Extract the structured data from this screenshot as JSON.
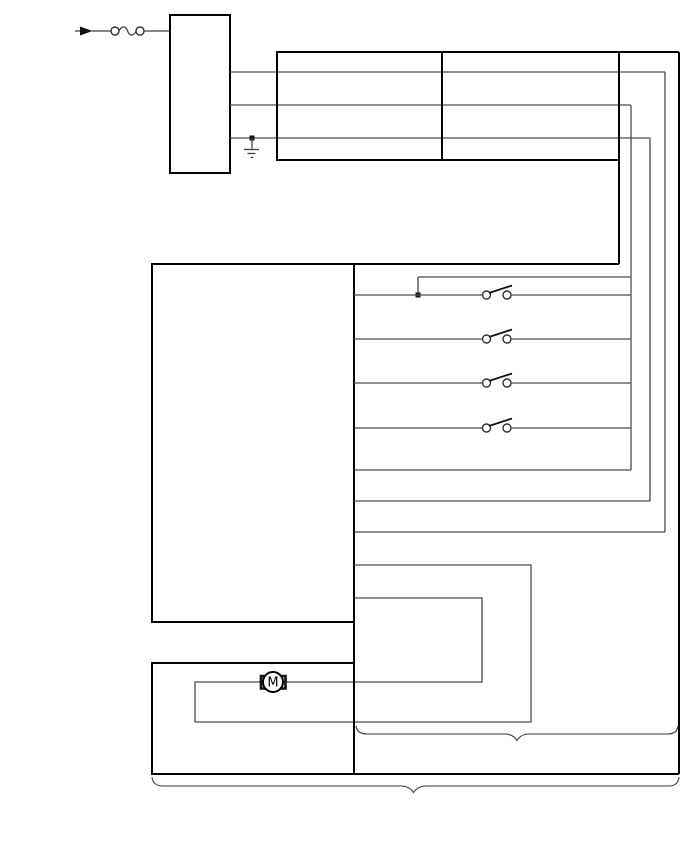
{
  "page": {
    "width": 688,
    "height": 852,
    "background": "#ffffff",
    "view_box": "0 0 688 852"
  },
  "colors": {
    "box_stroke": "#000000",
    "wire_stroke": "#4a4a4a",
    "brace_stroke": "#3a3a3a",
    "background": "#ffffff"
  },
  "motor": {
    "label": "M"
  },
  "legend": {
    "component_names": [
      "power-input-arrow",
      "inline-fuse",
      "power-source-box",
      "fuse-junction-box",
      "ground",
      "control-module-box",
      "switch-1",
      "switch-2",
      "switch-3",
      "switch-4",
      "motor",
      "motor-module-box",
      "section-brace-right",
      "section-brace-bottom"
    ]
  },
  "diagram": {
    "shapes": [
      {
        "type": "line",
        "name": "input-lead-tail",
        "cls": "wire2",
        "x1": 75,
        "y1": 31,
        "x2": 81,
        "y2": 31
      },
      {
        "type": "polygon",
        "name": "power-input-arrow-icon",
        "cls": "solid",
        "points": "80,26.5 92.5,31 80,35.5"
      },
      {
        "type": "line",
        "name": "input-lead",
        "cls": "wire2",
        "x1": 92,
        "y1": 31,
        "x2": 111,
        "y2": 31
      },
      {
        "type": "circle",
        "name": "fuse-contact-left",
        "cls": "contact",
        "cx": 115,
        "cy": 31,
        "r": 4
      },
      {
        "type": "path",
        "name": "fuse-icon",
        "cls": "wire2",
        "d": "M119,31 C122,25.5 125.5,25.5 127.6,31 C129.7,36.5 133.2,36.5 136.2,31"
      },
      {
        "type": "circle",
        "name": "fuse-contact-right",
        "cls": "contact",
        "cx": 140,
        "cy": 31,
        "r": 4
      },
      {
        "type": "line",
        "name": "fuse-to-box-lead",
        "cls": "wire2",
        "x1": 144,
        "y1": 31,
        "x2": 170,
        "y2": 31
      },
      {
        "type": "rect",
        "name": "power-source-box",
        "cls": "box",
        "x": 170,
        "y": 15,
        "w": 60,
        "h": 158
      },
      {
        "type": "line",
        "name": "feed-wire-1",
        "cls": "wire",
        "x1": 230,
        "y1": 72,
        "x2": 665,
        "y2": 72
      },
      {
        "type": "line",
        "name": "feed-wire-2",
        "cls": "wire",
        "x1": 230,
        "y1": 105,
        "x2": 631,
        "y2": 105
      },
      {
        "type": "line",
        "name": "feed-wire-3",
        "cls": "wire",
        "x1": 230,
        "y1": 138,
        "x2": 650,
        "y2": 138
      },
      {
        "type": "rect",
        "name": "ground-junction-dot",
        "cls": "solid",
        "x": 249.5,
        "y": 135.5,
        "w": 5,
        "h": 5
      },
      {
        "type": "line",
        "name": "ground-stem",
        "cls": "wire2",
        "x1": 252,
        "y1": 138,
        "x2": 252,
        "y2": 148.5
      },
      {
        "type": "line",
        "name": "ground-icon-bar-1",
        "cls": "wire2",
        "x1": 244,
        "y1": 149.5,
        "x2": 259,
        "y2": 149.5
      },
      {
        "type": "line",
        "name": "ground-icon-bar-2",
        "cls": "wire2",
        "x1": 247.5,
        "y1": 153.5,
        "x2": 255.5,
        "y2": 153.5
      },
      {
        "type": "line",
        "name": "ground-icon-bar-3",
        "cls": "wire2",
        "x1": 250.6,
        "y1": 157.5,
        "x2": 253.4,
        "y2": 157.5
      },
      {
        "type": "rect",
        "name": "fuse-junction-box",
        "cls": "box",
        "x": 277,
        "y": 52,
        "w": 342,
        "h": 108
      },
      {
        "type": "line",
        "name": "fuse-junction-box-divider",
        "cls": "box",
        "x1": 442,
        "y1": 52,
        "x2": 442,
        "y2": 160
      },
      {
        "type": "line",
        "name": "top-feed-extension",
        "cls": "box",
        "x1": 619,
        "y1": 52,
        "x2": 679,
        "y2": 52
      },
      {
        "type": "line",
        "name": "right-outer-feed-drop",
        "cls": "box",
        "x1": 679,
        "y1": 52,
        "x2": 679,
        "y2": 774
      },
      {
        "type": "line",
        "name": "junction-box-right-drop",
        "cls": "box",
        "x1": 619,
        "y1": 160,
        "x2": 619,
        "y2": 264
      },
      {
        "type": "line",
        "name": "feed-drop-x665",
        "cls": "wire",
        "x1": 665,
        "y1": 72,
        "x2": 665,
        "y2": 532
      },
      {
        "type": "line",
        "name": "feed-drop-x631",
        "cls": "wire",
        "x1": 631,
        "y1": 105,
        "x2": 631,
        "y2": 470
      },
      {
        "type": "line",
        "name": "feed-drop-x650",
        "cls": "wire",
        "x1": 650,
        "y1": 138,
        "x2": 650,
        "y2": 501
      },
      {
        "type": "rect",
        "name": "control-module-box",
        "cls": "box",
        "x": 152,
        "y": 264,
        "w": 202,
        "h": 358
      },
      {
        "type": "line",
        "name": "module-top-feed-wire",
        "cls": "box",
        "x1": 354,
        "y1": 264,
        "x2": 619,
        "y2": 264
      },
      {
        "type": "line",
        "name": "branch-wire-horizontal",
        "cls": "wire",
        "x1": 418,
        "y1": 277,
        "x2": 631,
        "y2": 277
      },
      {
        "type": "line",
        "name": "branch-wire-vertical",
        "cls": "wire",
        "x1": 418,
        "y1": 277,
        "x2": 418,
        "y2": 295
      },
      {
        "type": "rect",
        "name": "branch-junction-dot",
        "cls": "solid",
        "x": 415.5,
        "y": 292.5,
        "w": 5,
        "h": 5
      },
      {
        "type": "line",
        "name": "switch-1-wire-left",
        "cls": "wire",
        "x1": 354,
        "y1": 295,
        "x2": 482.5,
        "y2": 295
      },
      {
        "type": "circle",
        "name": "switch-1-contact-left",
        "cls": "contact",
        "cx": 486.5,
        "cy": 295,
        "r": 4
      },
      {
        "type": "line",
        "name": "switch-1-blade",
        "cls": "blade",
        "x1": 489,
        "y1": 293,
        "x2": 512,
        "y2": 285.5
      },
      {
        "type": "circle",
        "name": "switch-1-contact-right",
        "cls": "contact",
        "cx": 507,
        "cy": 295,
        "r": 4
      },
      {
        "type": "line",
        "name": "switch-1-wire-right",
        "cls": "wire",
        "x1": 511,
        "y1": 295,
        "x2": 631,
        "y2": 295
      },
      {
        "type": "line",
        "name": "switch-2-wire-left",
        "cls": "wire",
        "x1": 354,
        "y1": 339,
        "x2": 482.5,
        "y2": 339
      },
      {
        "type": "circle",
        "name": "switch-2-contact-left",
        "cls": "contact",
        "cx": 486.5,
        "cy": 339,
        "r": 4
      },
      {
        "type": "line",
        "name": "switch-2-blade",
        "cls": "blade",
        "x1": 489,
        "y1": 337,
        "x2": 512,
        "y2": 329.5
      },
      {
        "type": "circle",
        "name": "switch-2-contact-right",
        "cls": "contact",
        "cx": 507,
        "cy": 339,
        "r": 4
      },
      {
        "type": "line",
        "name": "switch-2-wire-right",
        "cls": "wire",
        "x1": 511,
        "y1": 339,
        "x2": 631,
        "y2": 339
      },
      {
        "type": "line",
        "name": "switch-3-wire-left",
        "cls": "wire",
        "x1": 354,
        "y1": 383,
        "x2": 482.5,
        "y2": 383
      },
      {
        "type": "circle",
        "name": "switch-3-contact-left",
        "cls": "contact",
        "cx": 486.5,
        "cy": 383,
        "r": 4
      },
      {
        "type": "line",
        "name": "switch-3-blade",
        "cls": "blade",
        "x1": 489,
        "y1": 381,
        "x2": 512,
        "y2": 373.5
      },
      {
        "type": "circle",
        "name": "switch-3-contact-right",
        "cls": "contact",
        "cx": 507,
        "cy": 383,
        "r": 4
      },
      {
        "type": "line",
        "name": "switch-3-wire-right",
        "cls": "wire",
        "x1": 511,
        "y1": 383,
        "x2": 631,
        "y2": 383
      },
      {
        "type": "line",
        "name": "switch-4-wire-left",
        "cls": "wire",
        "x1": 354,
        "y1": 428,
        "x2": 482.5,
        "y2": 428
      },
      {
        "type": "circle",
        "name": "switch-4-contact-left",
        "cls": "contact",
        "cx": 486.5,
        "cy": 428,
        "r": 4
      },
      {
        "type": "line",
        "name": "switch-4-blade",
        "cls": "blade",
        "x1": 489,
        "y1": 426,
        "x2": 512,
        "y2": 418.5
      },
      {
        "type": "circle",
        "name": "switch-4-contact-right",
        "cls": "contact",
        "cx": 507,
        "cy": 428,
        "r": 4
      },
      {
        "type": "line",
        "name": "switch-4-wire-right",
        "cls": "wire",
        "x1": 511,
        "y1": 428,
        "x2": 631,
        "y2": 428
      },
      {
        "type": "line",
        "name": "return-wire-row5",
        "cls": "wire",
        "x1": 354,
        "y1": 470,
        "x2": 631,
        "y2": 470
      },
      {
        "type": "line",
        "name": "return-wire-x650",
        "cls": "wire",
        "x1": 354,
        "y1": 501,
        "x2": 650,
        "y2": 501
      },
      {
        "type": "line",
        "name": "return-wire-x665",
        "cls": "wire",
        "x1": 354,
        "y1": 532,
        "x2": 665,
        "y2": 532
      },
      {
        "type": "line",
        "name": "center-bus-wire",
        "cls": "box",
        "x1": 354,
        "y1": 622,
        "x2": 354,
        "y2": 774
      },
      {
        "type": "polyline",
        "name": "motor-loop-wire",
        "cls": "wire",
        "points": "354,565 531,565 531,722 195,722 195,682 482,682 482,598 354,598"
      },
      {
        "type": "path",
        "name": "motor-bracket-left",
        "cls": "bracket",
        "d": "M266,676 L261,676 L261,688.5 L266,688.5"
      },
      {
        "type": "path",
        "name": "motor-bracket-right",
        "cls": "bracket",
        "d": "M280,676 L285.5,676 L285.5,688.5 L280,688.5"
      },
      {
        "type": "circle",
        "name": "motor-icon",
        "cls": "motorbody",
        "cx": 273,
        "cy": 682,
        "r": 10
      },
      {
        "type": "text",
        "name": "motor-label",
        "cls": "label",
        "x": 273,
        "y": 686.5,
        "bind": "motor.label"
      },
      {
        "type": "rect",
        "name": "motor-module-box",
        "cls": "box",
        "x": 152,
        "y": 663,
        "w": 202,
        "h": 111
      },
      {
        "type": "line",
        "name": "bottom-bus-wire",
        "cls": "box",
        "x1": 354,
        "y1": 774,
        "x2": 679,
        "y2": 774
      },
      {
        "type": "path",
        "name": "section-brace-right",
        "cls": "brace",
        "d": "M356,726 Q357,734 367,734 L505,734 Q513,734 517,740.5 Q521,734 529,734 L668,734 Q677,734 678,726"
      },
      {
        "type": "path",
        "name": "section-brace-bottom",
        "cls": "brace",
        "d": "M152,777 Q153,786 163,786 L401,786 Q409,786 413.5,792.5 Q418,786 426,786 L669,786 Q678,786 679,777"
      }
    ]
  }
}
